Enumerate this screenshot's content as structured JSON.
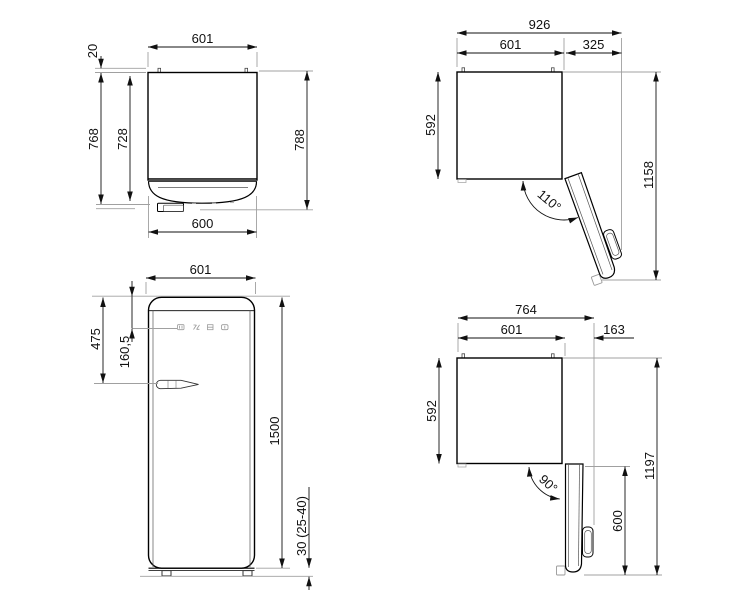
{
  "drawing": {
    "title": "Refrigerator dimension drawing",
    "units": "mm",
    "views": {
      "plan_closed": {
        "label": "top view door closed",
        "dims": {
          "width": "601",
          "rear_spacer": "20",
          "depth_body": "728",
          "depth_door": "768",
          "depth_total": "788",
          "door_width": "600"
        }
      },
      "plan_110": {
        "label": "top view door open 110",
        "dims": {
          "total_width": "926",
          "body_width": "601",
          "door_projection": "325",
          "depth": "592",
          "total_depth": "1158",
          "angle": "110°"
        }
      },
      "front": {
        "label": "front view",
        "dims": {
          "width": "601",
          "top_to_handle": "475",
          "top_to_panel": "160,5",
          "height": "1500",
          "feet_range": "30 (25-40)"
        }
      },
      "plan_90": {
        "label": "top view door open 90",
        "dims": {
          "total_width": "764",
          "body_width": "601",
          "door_projection": "163",
          "depth": "592",
          "total_depth": "1197",
          "door_depth": "600",
          "angle": "90°"
        }
      }
    }
  }
}
